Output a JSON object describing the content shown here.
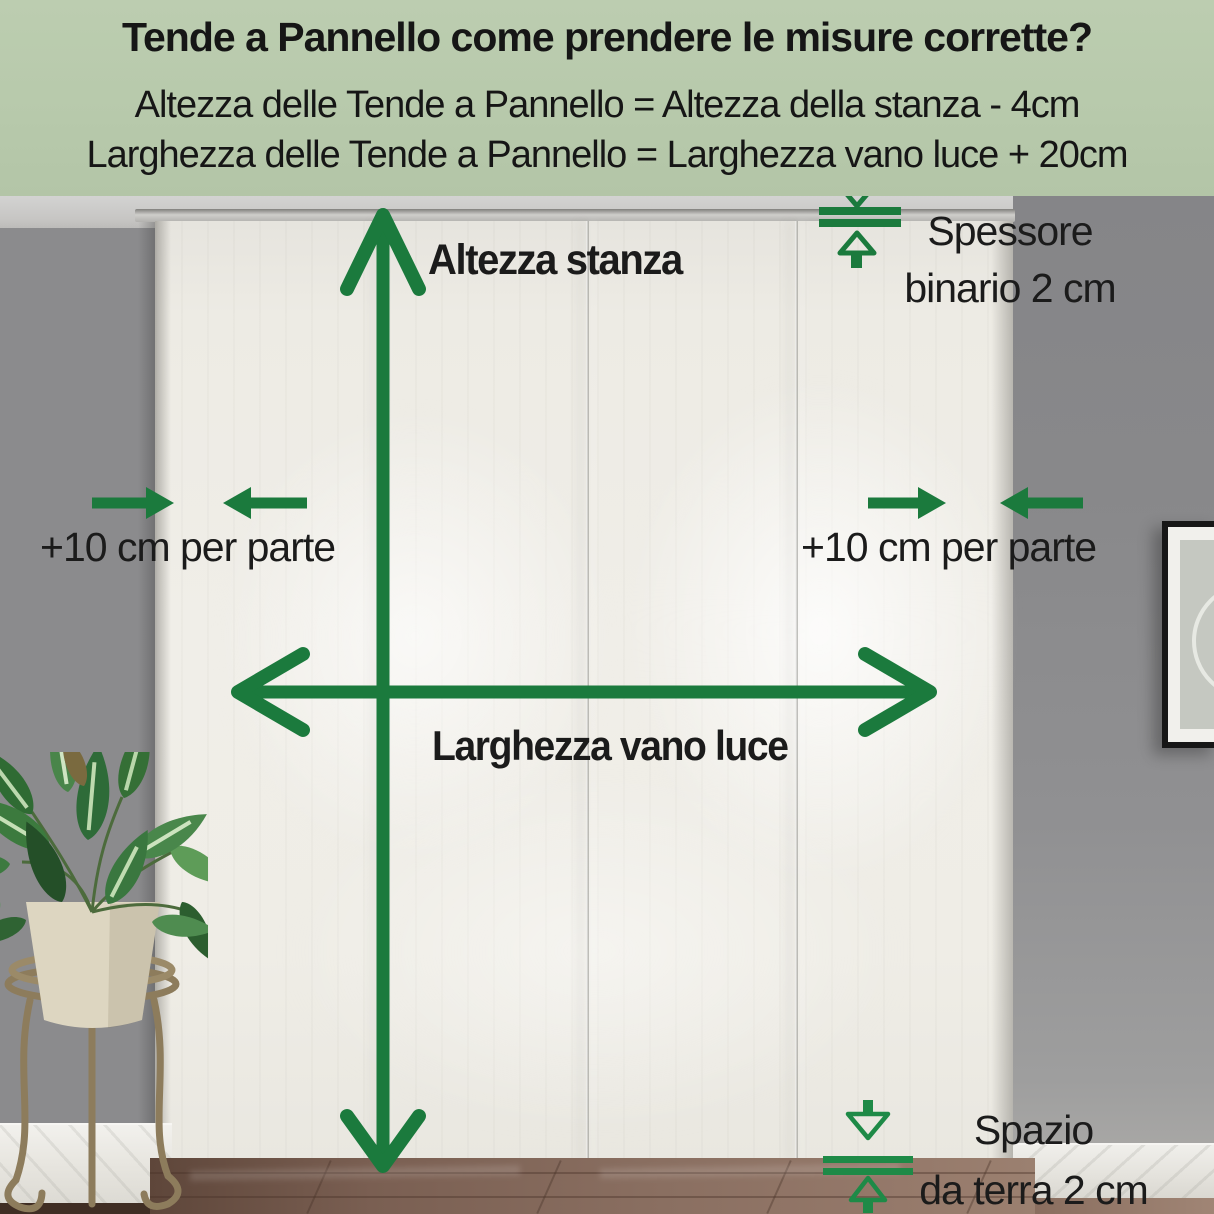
{
  "header": {
    "title": "Tende a Pannello come prendere le misure corrette?",
    "formula_line1": "Altezza delle Tende a Pannello = Altezza della stanza - 4cm",
    "formula_line2": "Larghezza delle Tende a Pannello = Larghezza vano luce + 20cm"
  },
  "labels": {
    "room_height": "Altezza stanza",
    "opening_width": "Larghezza vano luce",
    "left_margin": "+10 cm per parte",
    "right_margin": "+10 cm per parte",
    "track_thickness": {
      "line1": "Spessore",
      "line2": "binario 2 cm"
    },
    "floor_gap": {
      "line1": "Spazio",
      "line2": "da terra 2 cm"
    }
  },
  "icons": {
    "room_height_arrow": "double-headed-vertical-arrow",
    "opening_width_arrow": "double-headed-horizontal-arrow",
    "left_margin_arrows": "two-inward-horizontal-arrows",
    "right_margin_arrows": "two-inward-horizontal-arrows",
    "track_thickness_icon": "gap-measure-arrows-with-two-lines",
    "floor_gap_icon": "gap-measure-arrows-with-two-lines"
  },
  "colors": {
    "header_background": "#b7c9ab",
    "annotation_green": "#1b7a3d",
    "wall_gray": "#8b8b8d",
    "curtain_ivory": "#edebe4",
    "floor_brown": "#7c6255"
  }
}
